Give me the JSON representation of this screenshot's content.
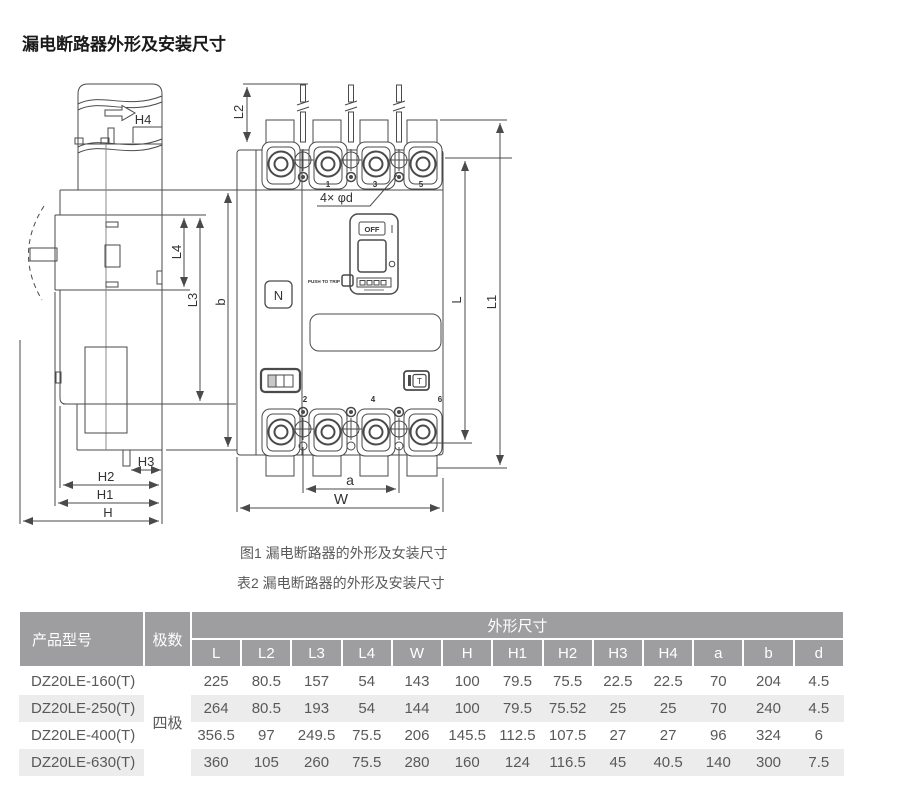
{
  "title": "漏电断路器外形及安装尺寸",
  "captions": {
    "figure": "图1 漏电断路器的外形及女装尺寸",
    "table": "表2 漏电断路器的外形及安装尺寸"
  },
  "drawing": {
    "dims": {
      "h4": "H4",
      "l2": "L2",
      "l4": "L4",
      "l3": "L3",
      "b": "b",
      "l": "L",
      "l1": "L1",
      "h3": "H3",
      "h2": "H2",
      "h1": "H1",
      "h": "H",
      "a": "a",
      "w": "W"
    },
    "holes_note": "4× φd",
    "panel": {
      "n": "N",
      "off": "OFF",
      "push_to_trip": "PUSH TO TRIP",
      "test": "T"
    },
    "pole_numbers_top": [
      "1",
      "3",
      "5"
    ],
    "pole_numbers_bottom": [
      "2",
      "4",
      "6"
    ]
  },
  "table": {
    "col_model": "产品型号",
    "col_poles": "极数",
    "col_dims_group": "外形尺寸",
    "dim_headers": [
      "L",
      "L2",
      "L3",
      "L4",
      "W",
      "H",
      "H1",
      "H2",
      "H3",
      "H4",
      "a",
      "b",
      "d"
    ],
    "poles_value": "四极",
    "rows": [
      {
        "model": "DZ20LE-160(T)",
        "values": [
          "225",
          "80.5",
          "157",
          "54",
          "143",
          "100",
          "79.5",
          "75.5",
          "22.5",
          "22.5",
          "70",
          "204",
          "4.5"
        ]
      },
      {
        "model": "DZ20LE-250(T)",
        "values": [
          "264",
          "80.5",
          "193",
          "54",
          "144",
          "100",
          "79.5",
          "75.52",
          "25",
          "25",
          "70",
          "240",
          "4.5"
        ]
      },
      {
        "model": "DZ20LE-400(T)",
        "values": [
          "356.5",
          "97",
          "249.5",
          "75.5",
          "206",
          "145.5",
          "112.5",
          "107.5",
          "27",
          "27",
          "96",
          "324",
          "6"
        ]
      },
      {
        "model": "DZ20LE-630(T)",
        "values": [
          "360",
          "105",
          "260",
          "75.5",
          "280",
          "160",
          "124",
          "116.5",
          "45",
          "40.5",
          "140",
          "300",
          "7.5"
        ]
      }
    ]
  },
  "colors": {
    "header_bg": "#9e9ea0",
    "row_alt_bg": "#ececec",
    "table_text": "#595959",
    "line": "#4a4a4a"
  }
}
